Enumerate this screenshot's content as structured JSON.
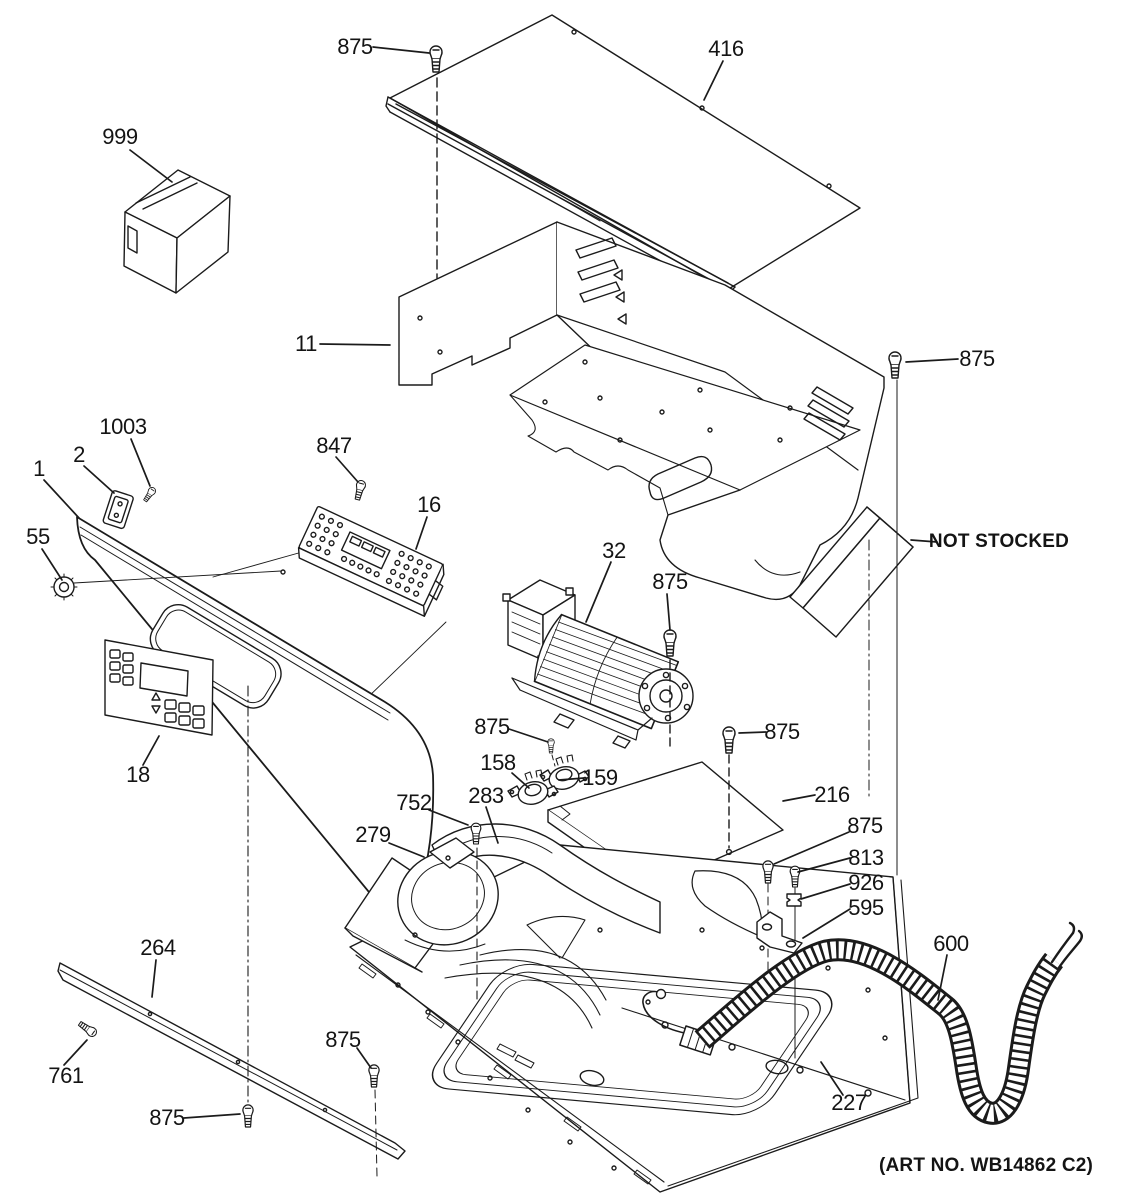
{
  "annotations": {
    "not_stocked": "NOT STOCKED",
    "art_no": "(ART NO. WB14862 C2)"
  },
  "callouts": [
    {
      "id": "999",
      "text": "999",
      "x": 120,
      "y": 137
    },
    {
      "id": "875-top-left",
      "text": "875",
      "x": 355,
      "y": 47
    },
    {
      "id": "416",
      "text": "416",
      "x": 726,
      "y": 49
    },
    {
      "id": "875-top-right",
      "text": "875",
      "x": 977,
      "y": 359
    },
    {
      "id": "11",
      "text": "11",
      "x": 306,
      "y": 344
    },
    {
      "id": "1003",
      "text": "1003",
      "x": 123,
      "y": 427
    },
    {
      "id": "2",
      "text": "2",
      "x": 79,
      "y": 455
    },
    {
      "id": "847",
      "text": "847",
      "x": 334,
      "y": 446
    },
    {
      "id": "16",
      "text": "16",
      "x": 429,
      "y": 505
    },
    {
      "id": "1",
      "text": "1",
      "x": 39,
      "y": 469
    },
    {
      "id": "55",
      "text": "55",
      "x": 38,
      "y": 537
    },
    {
      "id": "32",
      "text": "32",
      "x": 614,
      "y": 551
    },
    {
      "id": "875-blower",
      "text": "875",
      "x": 670,
      "y": 582
    },
    {
      "id": "18",
      "text": "18",
      "x": 138,
      "y": 775
    },
    {
      "id": "875-thermostat",
      "text": "875",
      "x": 492,
      "y": 727
    },
    {
      "id": "158",
      "text": "158",
      "x": 498,
      "y": 763
    },
    {
      "id": "159",
      "text": "159",
      "x": 600,
      "y": 778
    },
    {
      "id": "752",
      "text": "752",
      "x": 414,
      "y": 803
    },
    {
      "id": "283",
      "text": "283",
      "x": 486,
      "y": 796
    },
    {
      "id": "279",
      "text": "279",
      "x": 373,
      "y": 835
    },
    {
      "id": "216",
      "text": "216",
      "x": 832,
      "y": 795
    },
    {
      "id": "875-cover",
      "text": "875",
      "x": 782,
      "y": 732
    },
    {
      "id": "875-column",
      "text": "875",
      "x": 865,
      "y": 826
    },
    {
      "id": "813",
      "text": "813",
      "x": 866,
      "y": 858
    },
    {
      "id": "926",
      "text": "926",
      "x": 866,
      "y": 883
    },
    {
      "id": "595",
      "text": "595",
      "x": 866,
      "y": 908
    },
    {
      "id": "264",
      "text": "264",
      "x": 158,
      "y": 948
    },
    {
      "id": "600",
      "text": "600",
      "x": 951,
      "y": 944
    },
    {
      "id": "761",
      "text": "761",
      "x": 66,
      "y": 1076
    },
    {
      "id": "875-bottom-center",
      "text": "875",
      "x": 167,
      "y": 1118
    },
    {
      "id": "875-bottom-right",
      "text": "875",
      "x": 343,
      "y": 1040
    },
    {
      "id": "227",
      "text": "227",
      "x": 849,
      "y": 1103
    }
  ]
}
